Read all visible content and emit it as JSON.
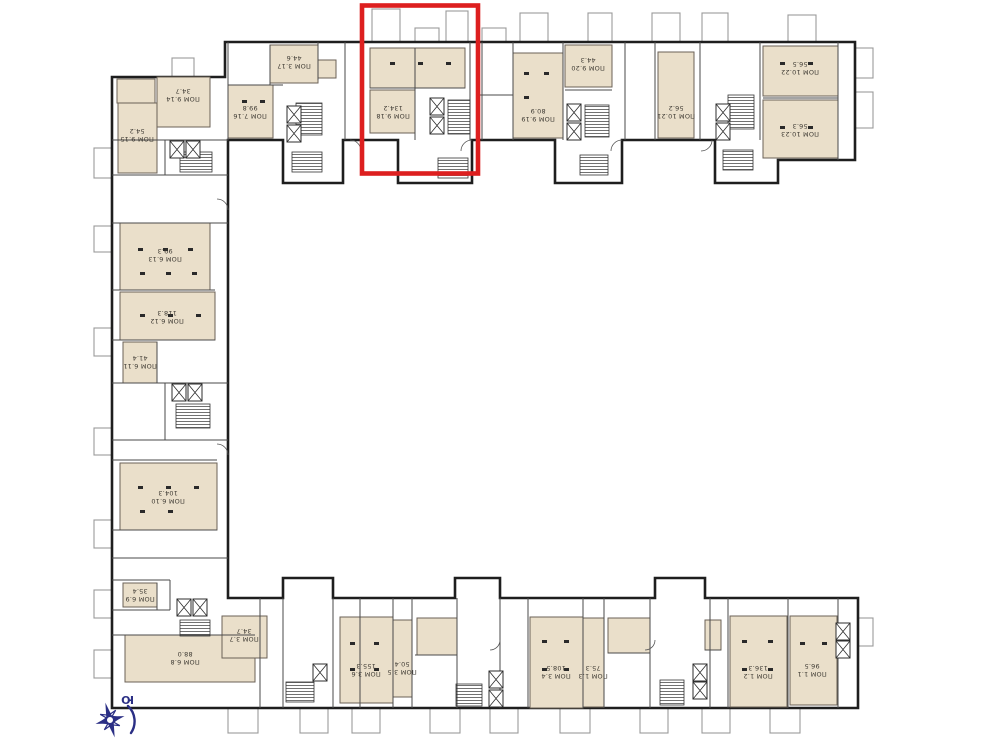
{
  "highlight": {
    "color": "#dd1f1f"
  },
  "compass": {
    "label": "Ю",
    "color": "#2b2f85"
  },
  "colors": {
    "background": "#ffffff",
    "wall": "#1e1e1e",
    "room_fill": "#eadfca",
    "balcony_outline": "#9a9a9a",
    "compass": "#2b2f85"
  },
  "units": [
    {
      "name": "ПОМ 7.16",
      "area": "99.8"
    },
    {
      "name": "ПОМ 3.17",
      "area": "44.6"
    },
    {
      "name": "ПОМ 9.18",
      "area": "134.2"
    },
    {
      "name": "ПОМ 9.19",
      "area": "80.9"
    },
    {
      "name": "ПОМ 9.20",
      "area": "44.3"
    },
    {
      "name": "ПОМ 10.21",
      "area": "56.2"
    },
    {
      "name": "ПОМ 10.22",
      "area": "56.5"
    },
    {
      "name": "ПОМ 10.23",
      "area": "56.3"
    },
    {
      "name": "ПОМ 9.14",
      "area": "34.7"
    },
    {
      "name": "ПОМ 9.15",
      "area": "54.2"
    },
    {
      "name": "ПОМ 6.13",
      "area": "99.3"
    },
    {
      "name": "ПОМ 6.12",
      "area": "118.3"
    },
    {
      "name": "ПОМ 6.11",
      "area": "41.4"
    },
    {
      "name": "ПОМ 6.10",
      "area": "104.3"
    },
    {
      "name": "ПОМ 6.9",
      "area": "35.4"
    },
    {
      "name": "ПОМ 6.8",
      "area": "88.0"
    },
    {
      "name": "ПОМ 3.7",
      "area": "34.7"
    },
    {
      "name": "ПОМ 3.6",
      "area": "155.3"
    },
    {
      "name": "ПОМ 3.5",
      "area": "50.4"
    },
    {
      "name": "ПОМ 3.4",
      "area": "108.5"
    },
    {
      "name": "ПОМ 1.3",
      "area": "75.3"
    },
    {
      "name": "ПОМ 1.2",
      "area": "136.3"
    },
    {
      "name": "ПОМ 1.1",
      "area": "96.5"
    }
  ]
}
